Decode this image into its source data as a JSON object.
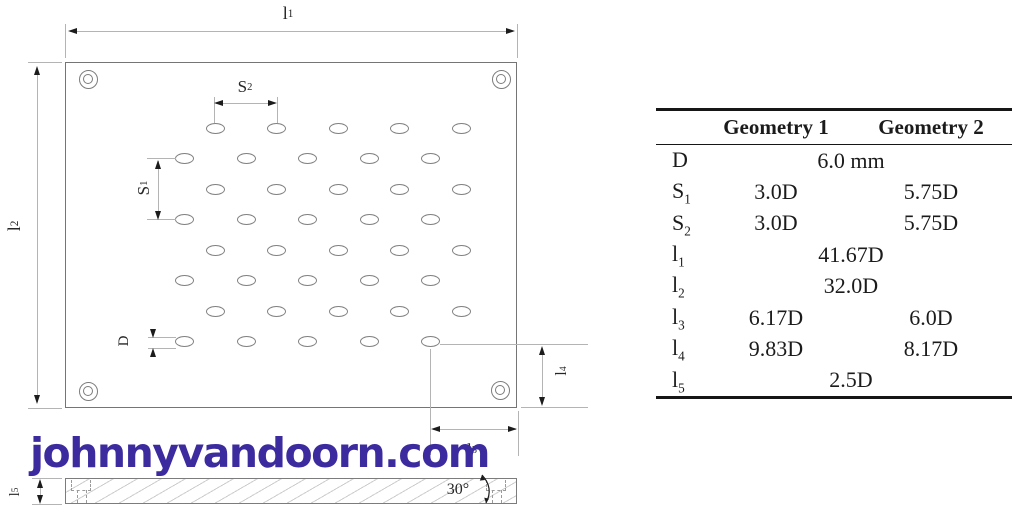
{
  "figure": {
    "watermark": "johnnyvandoorn.com",
    "watermark_color": "#3c2b9f"
  },
  "diagram": {
    "dim_labels": {
      "l1": {
        "base": "l",
        "sub": "1"
      },
      "l2": {
        "base": "l",
        "sub": "2"
      },
      "l3": {
        "base": "l",
        "sub": "3"
      },
      "l4": {
        "base": "l",
        "sub": "4"
      },
      "l5": {
        "base": "l",
        "sub": "5"
      },
      "s1": {
        "base": "S",
        "sub": "1"
      },
      "s2": {
        "base": "S",
        "sub": "2"
      },
      "d": {
        "base": "D",
        "sub": ""
      },
      "angle": "30°"
    },
    "holes": {
      "rows": 8,
      "cols": 5,
      "row1_y": 128,
      "row_dy": 30.57,
      "odd_row_x0": 215.5,
      "even_row_x0": 184.8,
      "col_dx": 61.4,
      "hole_w": 19,
      "hole_h": 11
    },
    "colors": {
      "outline": "#7c7c7c",
      "dim_line": "#b4b4b4",
      "arrow": "#1c1c1c"
    }
  },
  "table": {
    "headers": [
      "Geometry 1",
      "Geometry 2"
    ],
    "rows": [
      {
        "label": {
          "base": "D",
          "sub": ""
        },
        "span": "6.0 mm"
      },
      {
        "label": {
          "base": "S",
          "sub": "1"
        },
        "g1": "3.0D",
        "g2": "5.75D"
      },
      {
        "label": {
          "base": "S",
          "sub": "2"
        },
        "g1": "3.0D",
        "g2": "5.75D"
      },
      {
        "label": {
          "base": "l",
          "sub": "1"
        },
        "span": "41.67D"
      },
      {
        "label": {
          "base": "l",
          "sub": "2"
        },
        "span": "32.0D"
      },
      {
        "label": {
          "base": "l",
          "sub": "3"
        },
        "g1": "6.17D",
        "g2": "6.0D"
      },
      {
        "label": {
          "base": "l",
          "sub": "4"
        },
        "g1": "9.83D",
        "g2": "8.17D"
      },
      {
        "label": {
          "base": "l",
          "sub": "5"
        },
        "span": "2.5D"
      }
    ]
  }
}
